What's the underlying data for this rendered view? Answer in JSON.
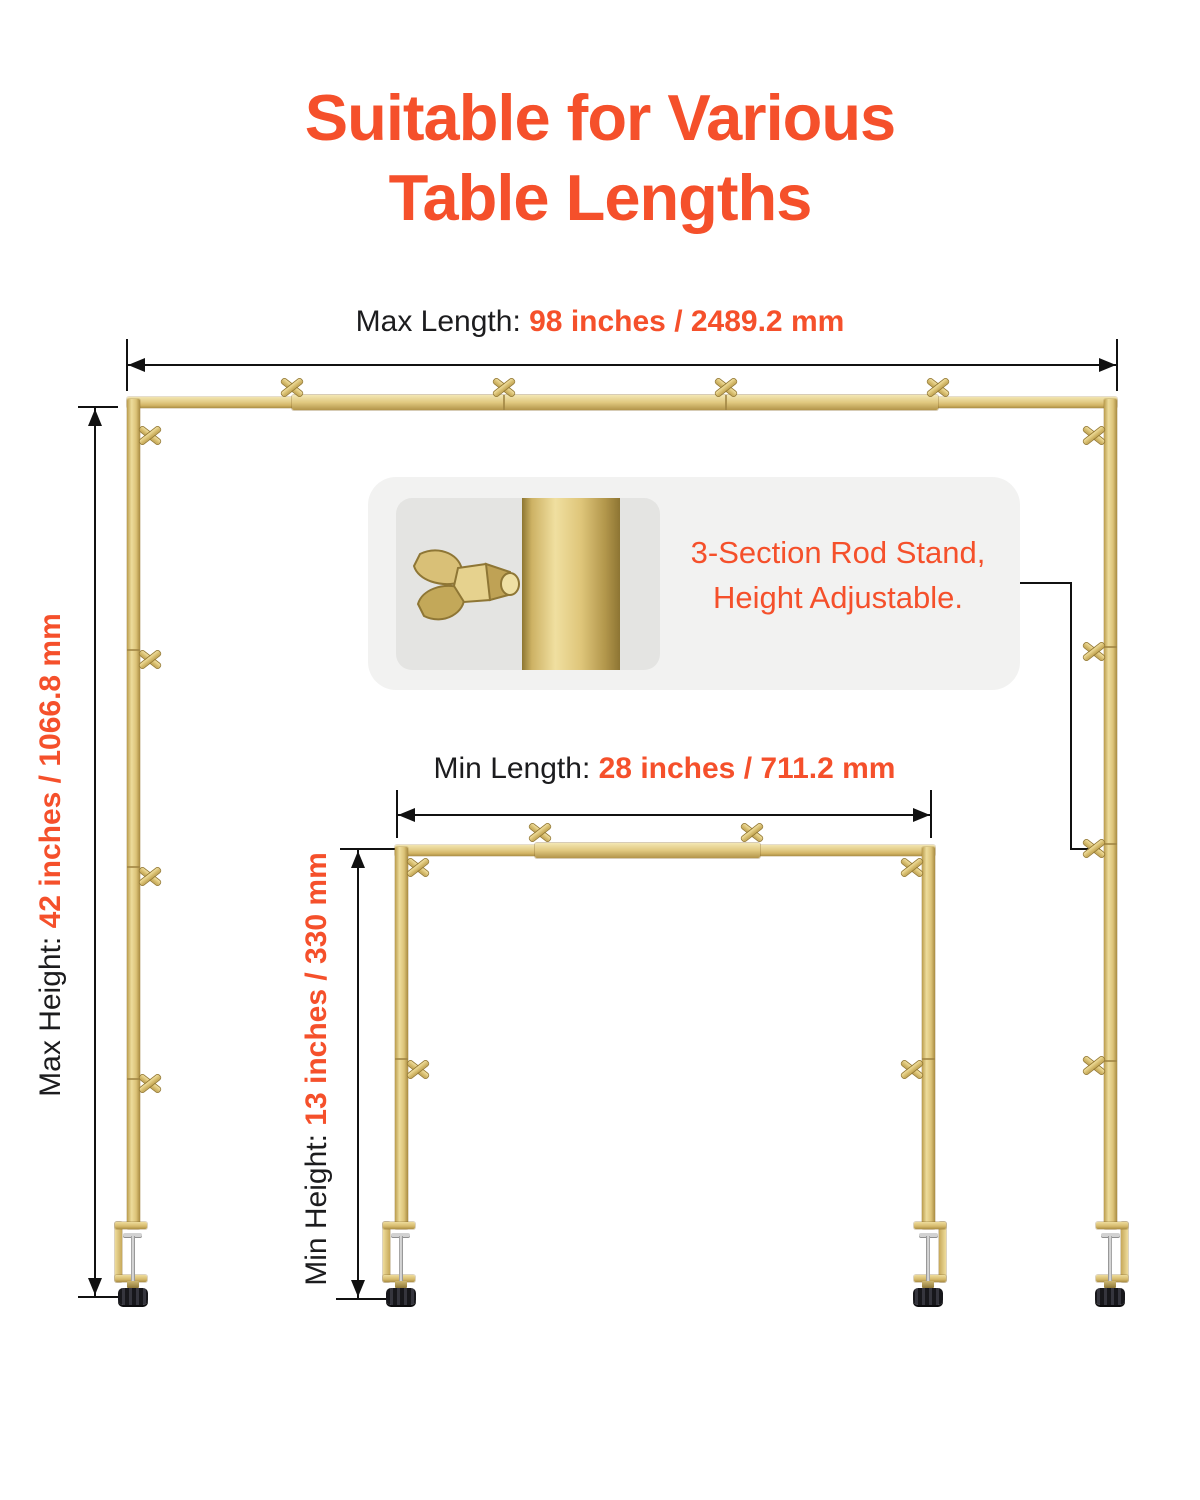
{
  "title": {
    "line1": "Suitable for Various",
    "line2": "Table Lengths"
  },
  "annotations": {
    "max_length": {
      "label": "Max Length: ",
      "value": "98 inches / 2489.2 mm"
    },
    "max_height": {
      "label": "Max Height: ",
      "value": "42 inches / 1066.8 mm"
    },
    "min_length": {
      "label": "Min Length: ",
      "value": "28 inches / 711.2 mm"
    },
    "min_height": {
      "label": "Min Height: ",
      "value": "13 inches / 330 mm"
    },
    "callout": {
      "line1": "3-Section Rod Stand,",
      "line2": "Height Adjustable."
    }
  },
  "colors": {
    "accent": "#F5502B",
    "text": "#1C1C1E",
    "gold": "#DCC57E",
    "callout_background": "#F2F2F1",
    "photo_background": "#E4E4E2",
    "knob_black": "#1F1F23"
  },
  "icons": {
    "wing_nut": "wing-nut-icon",
    "table_clamp": "table-clamp",
    "dimension_arrow": "dimension-arrow-icon"
  }
}
